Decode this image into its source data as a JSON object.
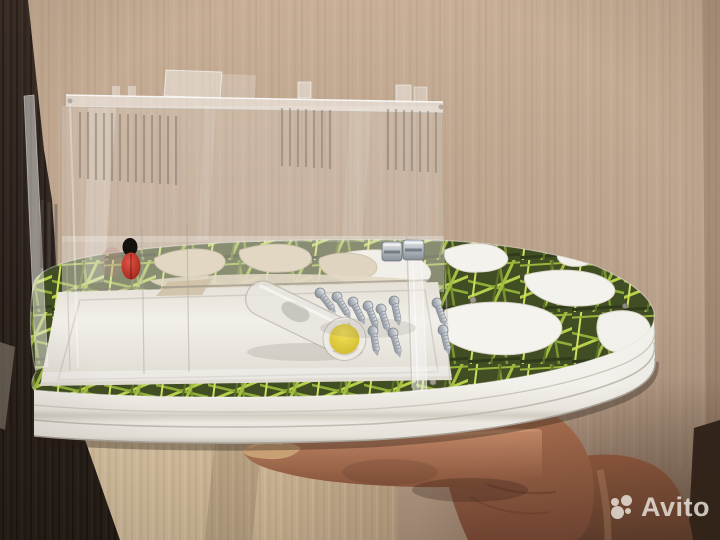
{
  "image": {
    "kind": "photo",
    "subject": "clear acrylic ant-farm formicarium with grass-print base held in a hand"
  },
  "watermark": {
    "brand": "Avito",
    "logo": "avito-dots-logo",
    "color": "#ece6de",
    "position": "bottom-right"
  },
  "palette": {
    "wall": "#c0a78f",
    "wardrobe": "#342a22",
    "door": "#d2bd9c",
    "base_side_white": "#edeae3",
    "grass_print_bright": "#b7cf4a",
    "grass_print_dark": "#414d22",
    "nest_chambers": "#f4f2ec",
    "chambers_behind_acrylic": "#d7caac",
    "acrylic_edge": "#f5f3ef",
    "test_tube_plug": "#e6d338",
    "screws_metal": "#b9bec4",
    "ladybug_red": "#c23227",
    "skin": "#a96f50"
  }
}
